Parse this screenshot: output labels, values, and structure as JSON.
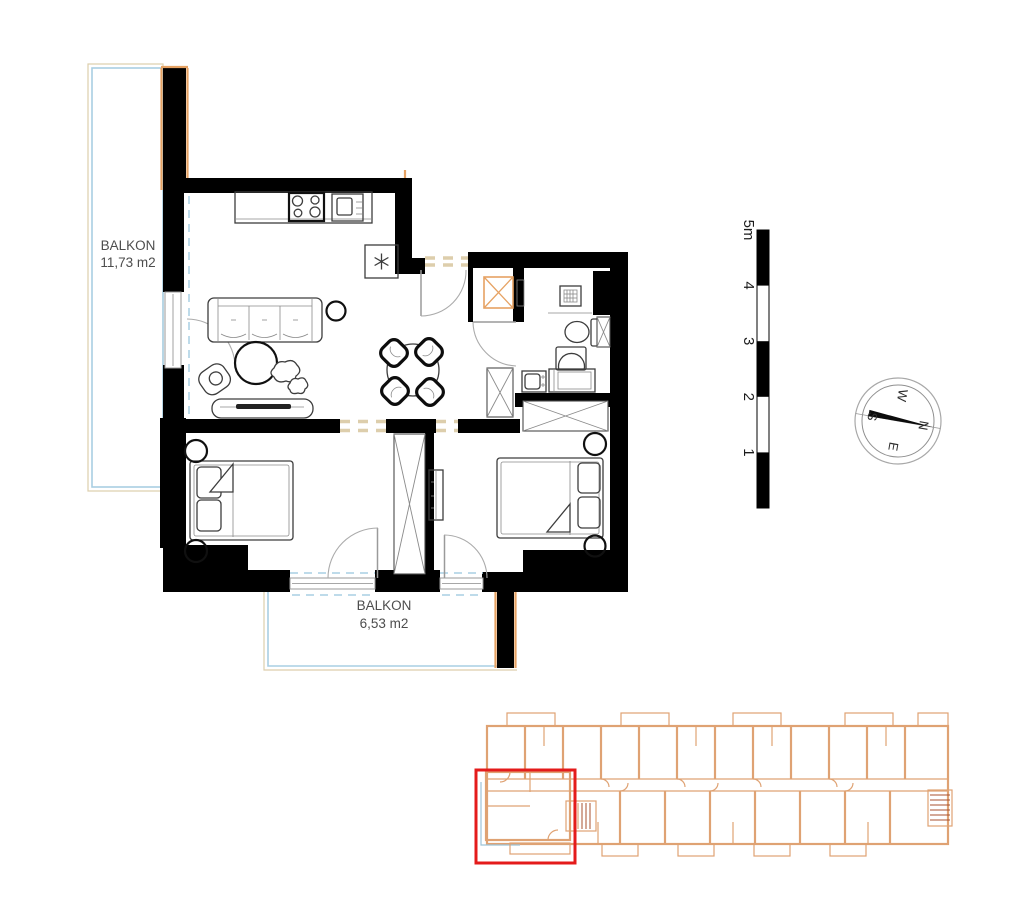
{
  "floor_plan": {
    "balconies": [
      {
        "label": "BALKON",
        "area": "11,73 m2"
      },
      {
        "label": "BALKON",
        "area": "6,53 m2"
      }
    ]
  },
  "scale_bar": {
    "labels": [
      "1",
      "2",
      "3",
      "4",
      "5m"
    ],
    "max_meters": 5
  },
  "compass": {
    "letters": {
      "n": "N",
      "e": "E",
      "s": "S",
      "w": "W"
    },
    "rotation_deg": 100
  },
  "colors": {
    "wall": "#000000",
    "furniture": "#3d3d3d",
    "insulation": "#e6a263",
    "balcony": "#a9cfe3",
    "opening": "#ddceac",
    "label": "#4d4d4d",
    "overview": "#dfa273",
    "overview_accent": "#a8502f",
    "overview_balcony": "#9cc3d8",
    "highlight": "#e41b1b"
  }
}
